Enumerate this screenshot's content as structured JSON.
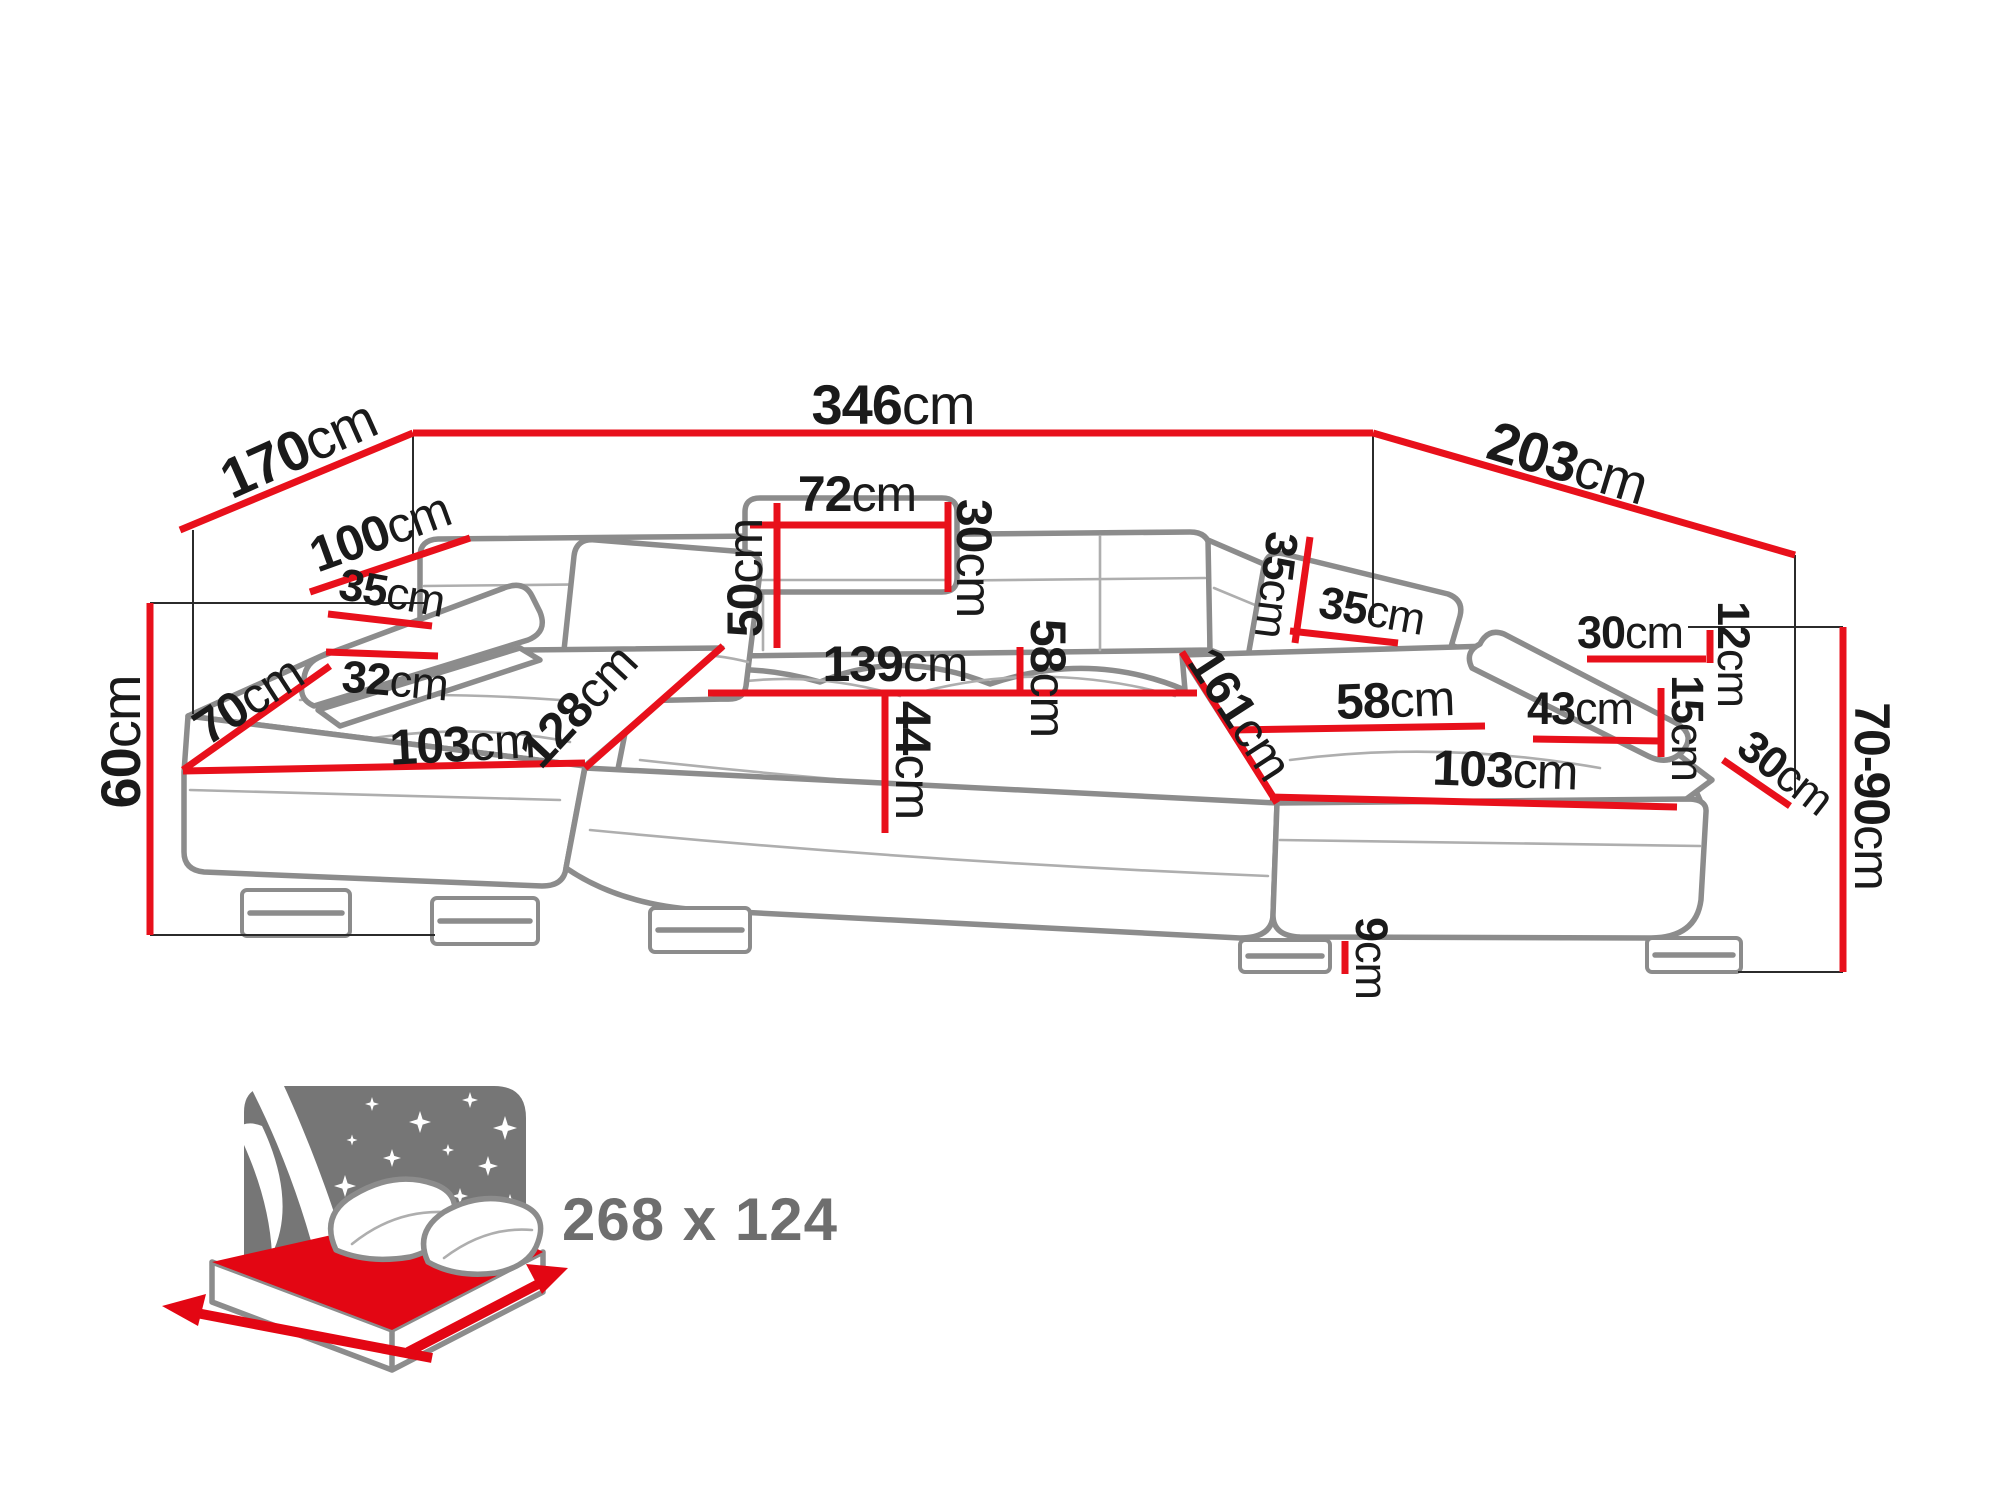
{
  "diagram": {
    "kind": "corner-sofa-dimension-diagram",
    "accent_color": "#e8101b",
    "sofa_outline_color": "#8c8c8c",
    "label_color": "#1a1a1a",
    "bed_icon_color": "#767676",
    "unit": "cm"
  },
  "labels": {
    "total_width": {
      "v": "346",
      "u": "cm"
    },
    "left_back_width": {
      "v": "170",
      "u": "cm"
    },
    "right_back_width": {
      "v": "203",
      "u": "cm"
    },
    "left_armrest_length": {
      "v": "100",
      "u": "cm"
    },
    "left_armrest_width": {
      "v": "35",
      "u": "cm"
    },
    "left_armrest_drop": {
      "v": "32",
      "u": "cm"
    },
    "left_front_depth": {
      "v": "70",
      "u": "cm"
    },
    "left_height": {
      "v": "60",
      "u": "cm"
    },
    "left_chaise_length": {
      "v": "103",
      "u": "cm"
    },
    "left_chaise_depth": {
      "v": "128",
      "u": "cm"
    },
    "headrest_width": {
      "v": "72",
      "u": "cm"
    },
    "headrest_height": {
      "v": "50",
      "u": "cm"
    },
    "headrest_depth": {
      "v": "30",
      "u": "cm"
    },
    "middle_seat_width": {
      "v": "139",
      "u": "cm"
    },
    "seat_height": {
      "v": "44",
      "u": "cm"
    },
    "middle_seat_depth": {
      "v": "58",
      "u": "cm"
    },
    "corner_seat_width": {
      "v": "161",
      "u": "cm"
    },
    "right_pillow_height": {
      "v": "35",
      "u": "cm"
    },
    "right_pillow_width": {
      "v": "35",
      "u": "cm"
    },
    "right_armrest_top": {
      "v": "30",
      "u": "cm"
    },
    "right_armrest_edge": {
      "v": "12",
      "u": "cm"
    },
    "right_armrest_side": {
      "v": "15",
      "u": "cm"
    },
    "right_armrest_length": {
      "v": "43",
      "u": "cm"
    },
    "right_seat_depth": {
      "v": "58",
      "u": "cm"
    },
    "right_chaise_length": {
      "v": "103",
      "u": "cm"
    },
    "right_armrest_width": {
      "v": "30",
      "u": "cm"
    },
    "right_height_range": {
      "v": "70-90",
      "u": "cm"
    },
    "leg_height": {
      "v": "9",
      "u": "cm"
    },
    "bed_size": {
      "v": "268 x 124",
      "u": ""
    }
  }
}
